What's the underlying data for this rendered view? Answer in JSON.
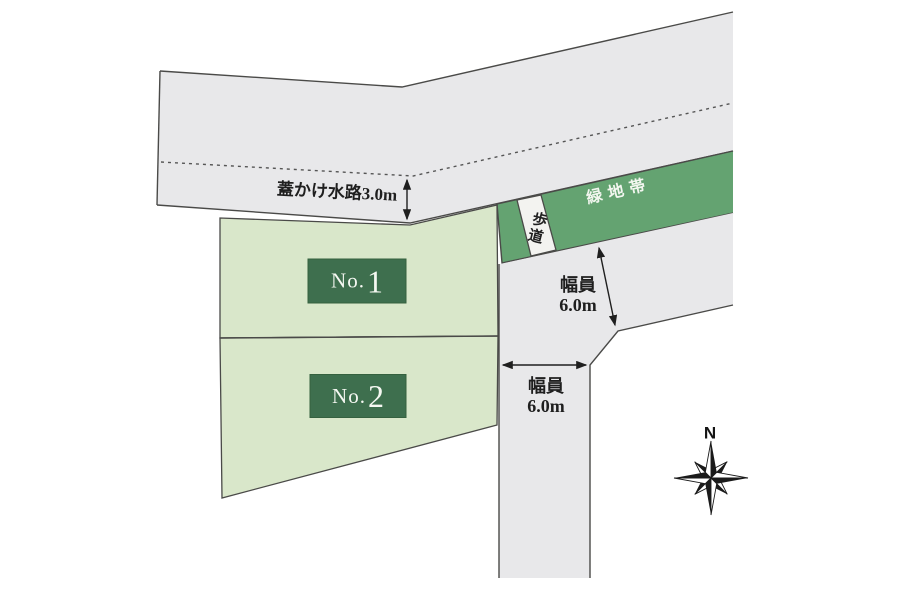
{
  "diagram": {
    "type": "lot-layout-plan",
    "waterway_label": "蓋かけ水路3.0m",
    "greenbelt_label": "緑地帯",
    "sidewalk_label": "歩道",
    "width_upper": {
      "line1": "幅員",
      "line2": "6.0m"
    },
    "width_lower": {
      "line1": "幅員",
      "line2": "6.0m"
    },
    "compass_label": "N"
  },
  "lots": [
    {
      "prefix": "No.",
      "number": "1"
    },
    {
      "prefix": "No.",
      "number": "2"
    }
  ],
  "colors": {
    "road_fill": "#e8e8ea",
    "lot_fill": "#d9e7ca",
    "greenbelt_fill": "#64a371",
    "lot_label_box": "#3e6f4e",
    "outline": "#4a4a48",
    "dashed_line": "#555555",
    "arrow": "#1f1f1f",
    "background": "#ffffff"
  }
}
